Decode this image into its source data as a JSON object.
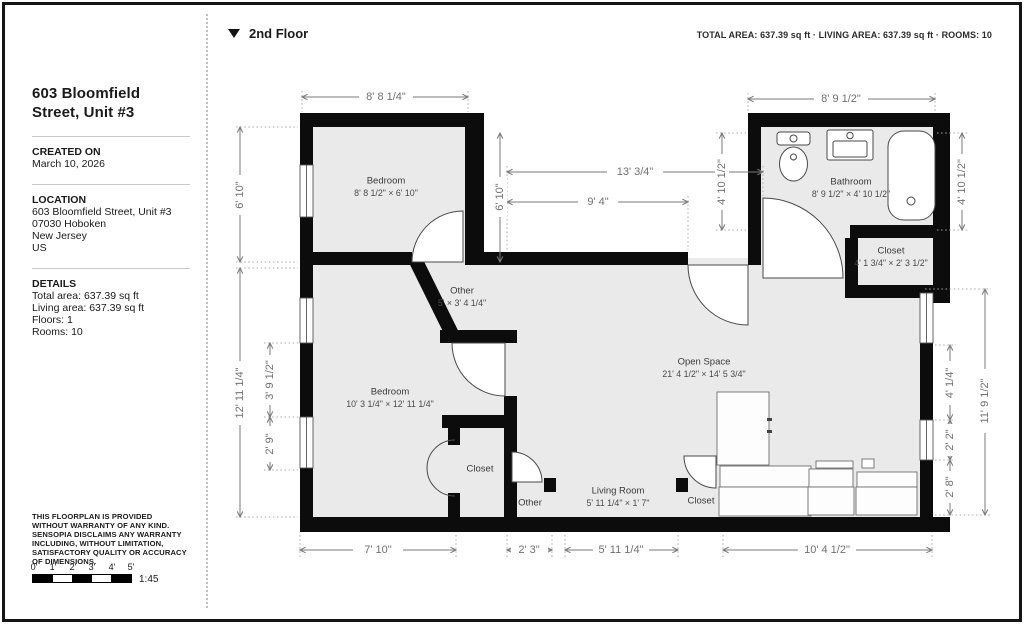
{
  "header": {
    "floor_label": "2nd Floor",
    "area_summary": "TOTAL AREA:  637.39 sq ft · LIVING AREA:  637.39 sq ft · ROOMS: 10"
  },
  "sidebar": {
    "title": "603 Bloomfield Street, Unit #3",
    "created_on_label": "CREATED ON",
    "created_on": "March 10, 2026",
    "location_label": "LOCATION",
    "location_lines": [
      "603 Bloomfield Street, Unit #3",
      "07030 Hoboken",
      "New Jersey",
      "US"
    ],
    "details_label": "DETAILS",
    "details_lines": [
      "Total area: 637.39 sq ft",
      "Living area: 637.39 sq ft",
      "Floors: 1",
      "Rooms: 10"
    ],
    "disclaimer": "THIS FLOORPLAN IS PROVIDED WITHOUT WARRANTY OF ANY KIND. SENSOPIA DISCLAIMS ANY WARRANTY INCLUDING, WITHOUT LIMITATION, SATISFACTORY QUALITY OR ACCURACY OF DIMENSIONS.",
    "scale": {
      "ticks": [
        "0'",
        "1'",
        "2'",
        "3'",
        "4'",
        "5'"
      ],
      "ratio": "1:45"
    }
  },
  "plan": {
    "rooms": {
      "bedroom_top": {
        "name": "Bedroom",
        "dims": "8' 8 1/2\" × 6' 10\""
      },
      "bathroom": {
        "name": "Bathroom",
        "dims": "8' 9 1/2\" × 4' 10 1/2\""
      },
      "bathroom_closet": {
        "name": "Closet",
        "dims": "4' 1 3/4\" × 2' 3 1/2\""
      },
      "hall_other": {
        "name": "Other",
        "dims": "5' × 3' 4 1/4\""
      },
      "bedroom_left": {
        "name": "Bedroom",
        "dims": "10' 3 1/4\" × 12' 11 1/4\""
      },
      "open_space": {
        "name": "Open Space",
        "dims": "21' 4 1/2\" × 14' 5 3/4\""
      },
      "closet_bedroom": {
        "name": "Closet"
      },
      "other_bottom": {
        "name": "Other"
      },
      "living_room": {
        "name": "Living Room",
        "dims": "5' 11 1/4\" × 1' 7\""
      },
      "closet_living": {
        "name": "Closet"
      }
    },
    "dimensions": {
      "bedroom_top_width": "8' 8 1/4\"",
      "bathroom_width": "8' 9 1/2\"",
      "mid_width": "13' 3/4\"",
      "mid_inner_width": "9' 4\"",
      "bedroom_top_height": "6' 10\"",
      "bathroom_height": "4' 10 1/2\"",
      "left_height": "12' 11 1/4\"",
      "left_window_a": "3' 9 1/2\"",
      "left_window_b": "2' 9\"",
      "right_seg_a": "4' 1/4\"",
      "right_seg_b": "2' 2\"",
      "right_seg_c": "2' 8\"",
      "right_height": "11' 9 1/2\"",
      "bottom_a": "7' 10\"",
      "bottom_b": "2' 3\"",
      "bottom_c": "5' 11 1/4\"",
      "bottom_d": "10' 4 1/2\""
    }
  }
}
